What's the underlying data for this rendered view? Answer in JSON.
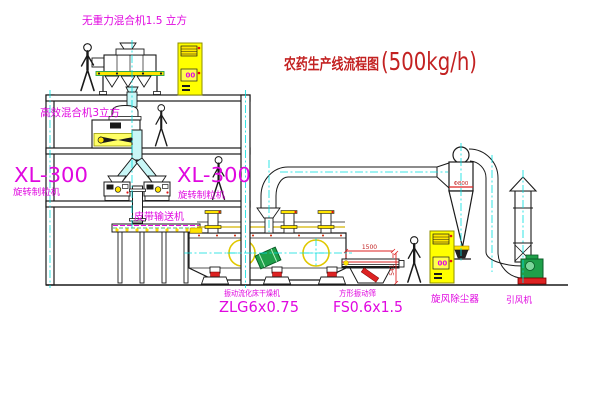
{
  "diagram": {
    "title": "农药生产线流程图",
    "capacity": "(500kg/h)"
  },
  "equipment": {
    "top_mixer": "无重力混合机1.5 立方",
    "floor2_mixer": "高效混合机3立方",
    "granulator_left": {
      "model": "XL-300",
      "name": "旋转制粒机"
    },
    "granulator_right": {
      "model": "XL-300",
      "name": "旋转制粒机"
    },
    "belt_conveyor": "皮带输送机",
    "dryer": {
      "name": "振动流化床干燥机",
      "model": "ZLG6x0.75"
    },
    "sieve": {
      "name": "方形振动筛",
      "model": "FS0.6x1.5"
    },
    "cyclone": {
      "name": "旋风除尘器",
      "marking": "Φ800"
    },
    "fan": {
      "name": "引风机"
    }
  },
  "dimensions": {
    "sieve_length": "1500",
    "sieve_height": "541"
  },
  "panels": {
    "roof_cabinet": "00",
    "ground_cabinet": "00"
  },
  "colors": {
    "label_magenta": "#e008e0",
    "title_red": "#c32222",
    "accent_yellow": "#ffe400",
    "centerline_cyan": "#00dede",
    "machine_green": "#1fa04a",
    "dimension_red": "#dd2222"
  }
}
